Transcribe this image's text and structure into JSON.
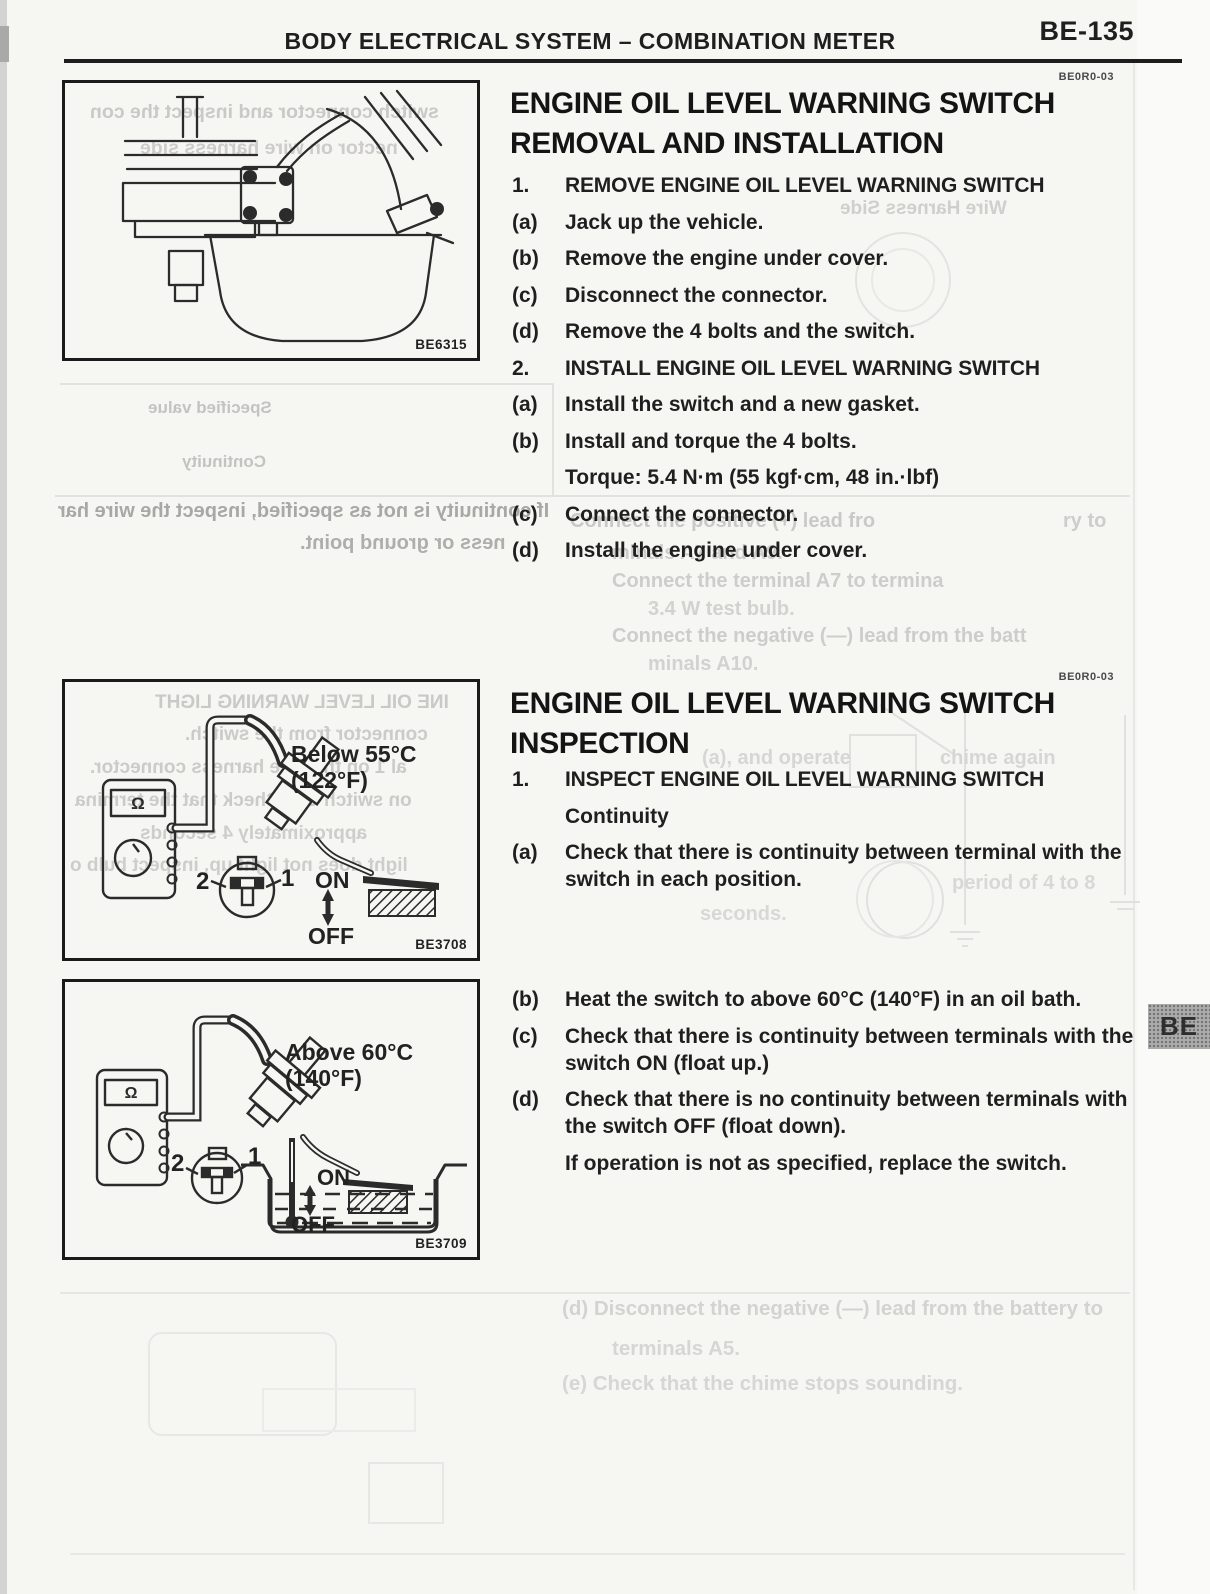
{
  "header": {
    "title_left": "BODY ELECTRICAL SYSTEM",
    "title_separator": "–",
    "title_right": "COMBINATION METER",
    "page_number": "BE-135"
  },
  "side_tab": {
    "label": "BE"
  },
  "removal": {
    "section_code": "BE0R0-03",
    "heading_line1": "ENGINE OIL LEVEL WARNING SWITCH",
    "heading_line2": "REMOVAL AND INSTALLATION",
    "steps": [
      {
        "label": "1.",
        "text": "REMOVE ENGINE OIL LEVEL WARNING SWITCH"
      },
      {
        "label": "(a)",
        "text": "Jack up the vehicle."
      },
      {
        "label": "(b)",
        "text": "Remove the engine under cover."
      },
      {
        "label": "(c)",
        "text": "Disconnect the connector."
      },
      {
        "label": "(d)",
        "text": "Remove the 4 bolts and the switch."
      },
      {
        "label": "2.",
        "text": "INSTALL ENGINE OIL LEVEL WARNING SWITCH"
      },
      {
        "label": "(a)",
        "text": "Install the switch and a new gasket."
      },
      {
        "label": "(b)",
        "text": "Install and torque the 4 bolts."
      },
      {
        "label": "",
        "text": "Torque: 5.4 N·m (55 kgf·cm, 48 in.·lbf)"
      },
      {
        "label": "(c)",
        "text": "Connect the connector."
      },
      {
        "label": "(d)",
        "text": "Install the engine under cover."
      }
    ]
  },
  "inspection": {
    "section_code": "BE0R0-03",
    "heading_line1": "ENGINE OIL LEVEL WARNING SWITCH",
    "heading_line2": "INSPECTION",
    "steps": [
      {
        "label": "1.",
        "text": "INSPECT ENGINE OIL LEVEL WARNING SWITCH"
      },
      {
        "label": "",
        "text": "Continuity"
      },
      {
        "label": "(a)",
        "text": "Check that there is continuity between terminal with the switch in each position."
      }
    ],
    "steps2": [
      {
        "label": "(b)",
        "text": "Heat the switch to above 60°C (140°F) in an oil bath."
      },
      {
        "label": "(c)",
        "text": "Check that there is continuity between terminals with the switch ON (float up.)"
      },
      {
        "label": "(d)",
        "text": "Check that there is no continuity between terminals with the switch OFF (float down)."
      },
      {
        "label": "",
        "text": "If operation is not as specified, replace the switch."
      }
    ]
  },
  "figures": {
    "fig1": {
      "caption": "BE6315"
    },
    "fig2": {
      "caption": "BE3708",
      "temp_line1": "Below 55°C",
      "temp_line2": "(122°F)",
      "on_label": "ON",
      "off_label": "OFF",
      "terminal_2": "2",
      "terminal_1": "1",
      "ohm": "Ω"
    },
    "fig3": {
      "caption": "BE3709",
      "temp_line1": "Above 60°C",
      "temp_line2": "(140°F)",
      "on_label": "ON",
      "off_label": "OFF",
      "terminal_2": "2",
      "terminal_1": "1",
      "ohm": "Ω"
    }
  },
  "ghosts": {
    "fig1_m1": "switch connector and inspect the con",
    "fig1_m2": "nector on wire harness side",
    "harness_side": "Wire Harness Side",
    "table_m1": "Specified value",
    "table_m2": "Continuity",
    "mid_m1": "If continuity is not as specified, inspect the wire har",
    "mid_m2": "ness or ground point.",
    "col_f1": "Connect the positive (+) lead fro",
    "col_f1b": "ry to",
    "col_f2": "minals A7 and A9.",
    "col_f3": "Connect the terminal A7 to termina",
    "col_f4": "3.4 W test bulb.",
    "col_f5": "Connect the negative (—) lead from the batt",
    "col_f6": "minals A10.",
    "insp_f1": "(a), and operate",
    "insp_f2": "chime again",
    "insp_f3": "period of 4 to 8",
    "insp_f4": "seconds.",
    "fig2_m1": "INE OIL LEVEL WARNING LIGHT",
    "fig2_m2": "connector from the switch.",
    "fig2_m3": "al 1 on the wire harness connector.",
    "fig2_m4": "on switch ON. Check that the termina",
    "fig2_m5": "approximately 4 seconds",
    "fig2_m6": "light does not light up, inspect bulb o",
    "bot_f1": "(d) Disconnect the negative (—) lead from the battery to",
    "bot_f2": "terminals A5.",
    "bot_f3": "(e) Check that the chime stops sounding."
  }
}
